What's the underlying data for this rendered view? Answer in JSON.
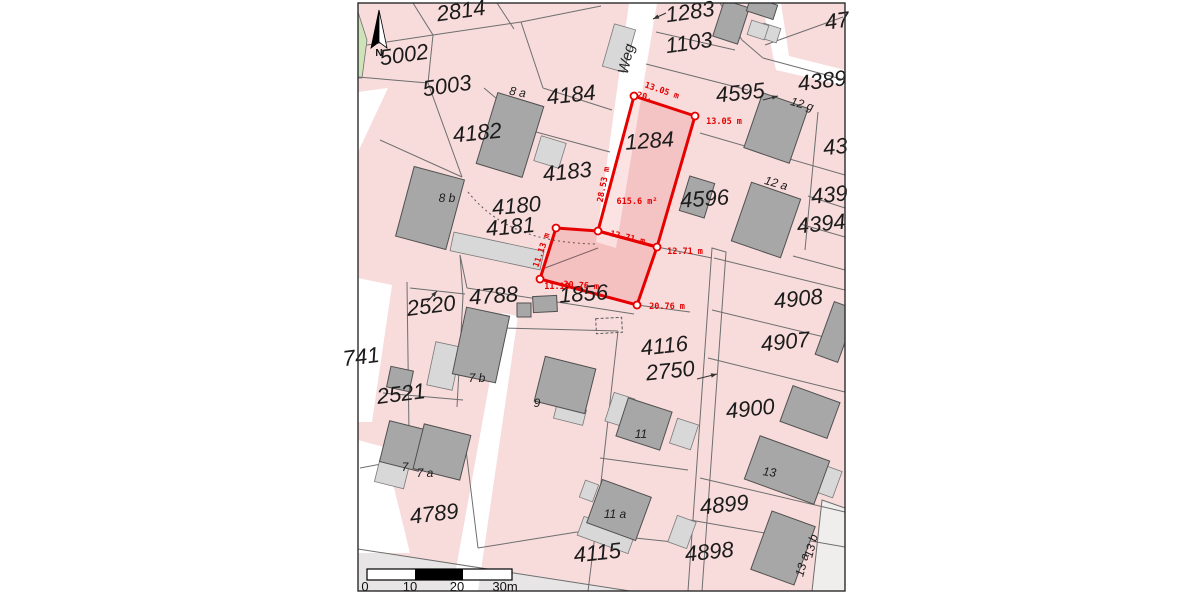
{
  "map": {
    "compass": {
      "label": "N",
      "x": 379,
      "y": 56
    },
    "street_label": {
      "text": "Weg",
      "x": 631,
      "y": 60,
      "rot": -77
    },
    "selected_parcel": {
      "number": "1284",
      "area_label": "615.6 m²",
      "measurement_labels": [
        {
          "text": "20.",
          "x": 644,
          "y": 99,
          "rot": 12
        },
        {
          "text": "13.05 m",
          "x": 661,
          "y": 93,
          "rot": 19
        },
        {
          "text": "13.05 m",
          "x": 724,
          "y": 124,
          "rot": 0
        },
        {
          "text": "28.53 m",
          "x": 606,
          "y": 185,
          "rot": -79
        },
        {
          "text": "12.71 m",
          "x": 627,
          "y": 240,
          "rot": 13
        },
        {
          "text": "12.71 m",
          "x": 685,
          "y": 254,
          "rot": 0
        },
        {
          "text": "11.13 m",
          "x": 544,
          "y": 251,
          "rot": -71
        },
        {
          "text": "11.13",
          "x": 557,
          "y": 289,
          "rot": 0
        },
        {
          "text": "20.76 m",
          "x": 581,
          "y": 288,
          "rot": 4
        },
        {
          "text": "20.76 m",
          "x": 667,
          "y": 309,
          "rot": 0
        }
      ],
      "area_pos": {
        "x": 637,
        "y": 204
      },
      "number_pos": {
        "x": 650,
        "y": 148,
        "rot": -4
      }
    },
    "parcel_labels": [
      {
        "text": "2814",
        "x": 462,
        "y": 18,
        "rot": -8
      },
      {
        "text": "5002",
        "x": 405,
        "y": 62,
        "rot": -8
      },
      {
        "text": "5003",
        "x": 448,
        "y": 93,
        "rot": -8
      },
      {
        "text": "1283",
        "x": 691,
        "y": 19,
        "rot": -8
      },
      {
        "text": "1103",
        "x": 690,
        "y": 50,
        "rot": -8
      },
      {
        "text": "47",
        "x": 838,
        "y": 28,
        "rot": -8
      },
      {
        "text": "4389",
        "x": 823,
        "y": 88,
        "rot": -7
      },
      {
        "text": "4184",
        "x": 572,
        "y": 102,
        "rot": -6
      },
      {
        "text": "4182",
        "x": 478,
        "y": 140,
        "rot": -6
      },
      {
        "text": "4183",
        "x": 568,
        "y": 179,
        "rot": -6
      },
      {
        "text": "4180",
        "x": 517,
        "y": 213,
        "rot": -5
      },
      {
        "text": "4181",
        "x": 511,
        "y": 234,
        "rot": -5
      },
      {
        "text": "4595",
        "x": 741,
        "y": 100,
        "rot": -6
      },
      {
        "text": "43",
        "x": 836,
        "y": 154,
        "rot": -6
      },
      {
        "text": "4596",
        "x": 705,
        "y": 206,
        "rot": -4
      },
      {
        "text": "439",
        "x": 830,
        "y": 202,
        "rot": -6
      },
      {
        "text": "4394",
        "x": 822,
        "y": 231,
        "rot": -6
      },
      {
        "text": "4788",
        "x": 494,
        "y": 303,
        "rot": -4
      },
      {
        "text": "1856",
        "x": 584,
        "y": 301,
        "rot": -4
      },
      {
        "text": "2520",
        "x": 432,
        "y": 313,
        "rot": -7
      },
      {
        "text": "2521",
        "x": 402,
        "y": 401,
        "rot": -7
      },
      {
        "text": "741",
        "x": 362,
        "y": 364,
        "rot": -7
      },
      {
        "text": "4908",
        "x": 799,
        "y": 306,
        "rot": -6
      },
      {
        "text": "4907",
        "x": 786,
        "y": 349,
        "rot": -6
      },
      {
        "text": "4116",
        "x": 665,
        "y": 353,
        "rot": -6
      },
      {
        "text": "2750",
        "x": 671,
        "y": 378,
        "rot": -6
      },
      {
        "text": "4900",
        "x": 751,
        "y": 416,
        "rot": -6
      },
      {
        "text": "4789",
        "x": 435,
        "y": 521,
        "rot": -7
      },
      {
        "text": "4899",
        "x": 725,
        "y": 512,
        "rot": -6
      },
      {
        "text": "4898",
        "x": 710,
        "y": 559,
        "rot": -6
      },
      {
        "text": "4115",
        "x": 598,
        "y": 560,
        "rot": -6
      }
    ],
    "house_labels": [
      {
        "text": "8 a",
        "x": 517,
        "y": 96,
        "rot": 10
      },
      {
        "text": "8 b",
        "x": 447,
        "y": 202,
        "rot": 0
      },
      {
        "text": "12 g",
        "x": 801,
        "y": 108,
        "rot": 16
      },
      {
        "text": "12 a",
        "x": 775,
        "y": 187,
        "rot": 16
      },
      {
        "text": "7 b",
        "x": 477,
        "y": 382,
        "rot": 0
      },
      {
        "text": "9",
        "x": 537,
        "y": 407,
        "rot": 0
      },
      {
        "text": "11",
        "x": 641,
        "y": 438,
        "rot": 0
      },
      {
        "text": "7",
        "x": 405,
        "y": 471,
        "rot": 0
      },
      {
        "text": "7 a",
        "x": 425,
        "y": 477,
        "rot": 0
      },
      {
        "text": "13",
        "x": 769,
        "y": 476,
        "rot": 8
      },
      {
        "text": "11 a",
        "x": 615,
        "y": 518,
        "rot": 0
      },
      {
        "text": "13 a",
        "x": 806,
        "y": 566,
        "rot": -75
      },
      {
        "text": "13 b",
        "x": 815,
        "y": 547,
        "rot": -75
      }
    ],
    "scalebar": {
      "tick_labels": [
        {
          "text": "0",
          "x": 365
        },
        {
          "text": "10",
          "x": 410
        },
        {
          "text": "20",
          "x": 457
        },
        {
          "text": "30m",
          "x": 505
        }
      ]
    },
    "colors": {
      "parcel_fill": "#f8dbdb",
      "road_fill": "#ffffff",
      "building_fill": "#a7a7a7",
      "building_light_fill": "#d8d8d8",
      "boundary_line": "#6e6e6e",
      "selection_red": "#e60000",
      "green_area": "#cfe3b9",
      "margin_band": "#e7e5e5"
    }
  }
}
